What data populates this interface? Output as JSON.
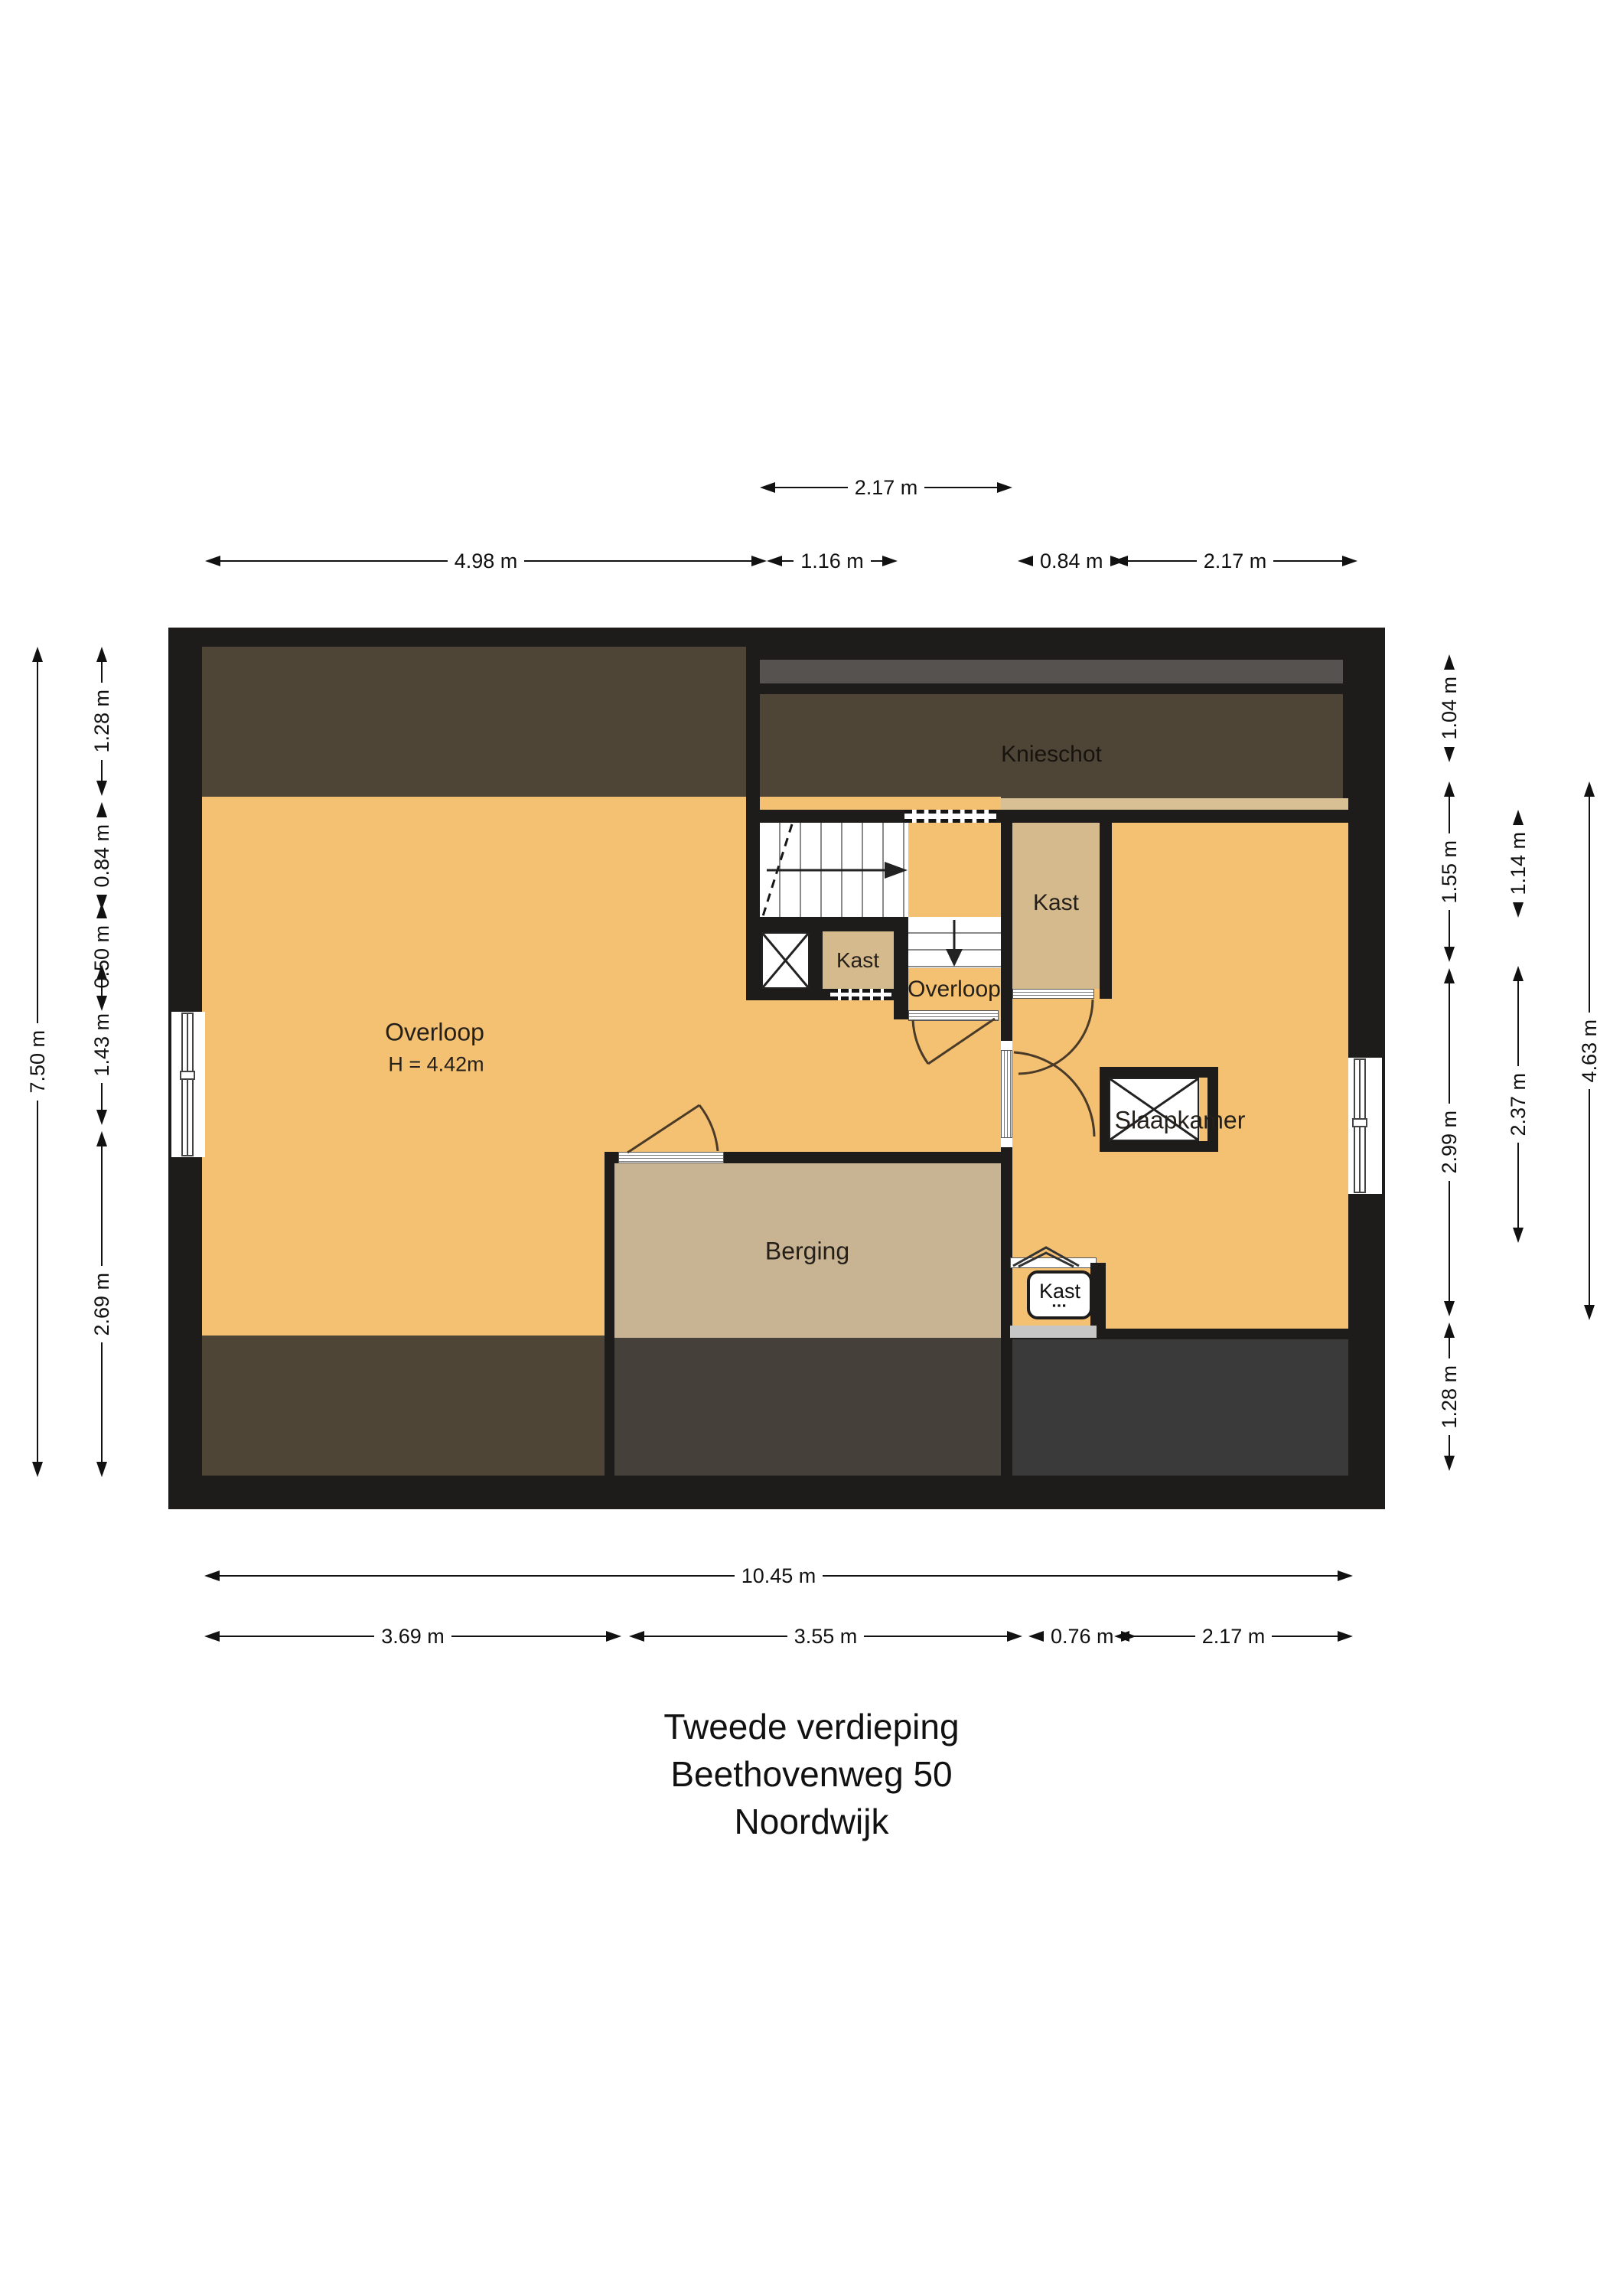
{
  "title": {
    "line1": "Tweede verdieping",
    "line2": "Beethovenweg 50",
    "line3": "Noordwijk"
  },
  "rooms": {
    "knieschot": "Knieschot",
    "overloop_main": "Overloop",
    "overloop_main_height": "H = 4.42m",
    "overloop_small": "Overloop",
    "slaapkamer": "Slaapkamer",
    "berging": "Berging",
    "kast_upper": "Kast",
    "kast_stair": "Kast",
    "kast_lower": "Kast"
  },
  "dimensions": {
    "top_row1": [
      "2.17 m"
    ],
    "top_row2": [
      "4.98 m",
      "1.16 m",
      "0.84 m",
      "2.17 m"
    ],
    "left_outer": [
      "7.50 m"
    ],
    "left_inner": [
      "1.28 m",
      "0.84 m",
      "0.50 m",
      "1.43 m",
      "2.69 m"
    ],
    "right_col1": [
      "1.04 m",
      "1.55 m",
      "2.99 m",
      "1.28 m"
    ],
    "right_col2": [
      "1.14 m",
      "2.37 m"
    ],
    "right_col3": [
      "4.63 m"
    ],
    "bottom_row1": [
      "10.45 m"
    ],
    "bottom_row2": [
      "3.69 m",
      "3.55 m",
      "0.76 m",
      "2.17 m"
    ]
  },
  "icons": {
    "stair_up_arrow": "stair-direction-right",
    "stair_down_arrow": "stair-direction-down",
    "shaft_cross": "duct-shaft-cross",
    "fixture": "meter-fixture"
  },
  "colors": {
    "wall": "#1d1c1a",
    "floor_orange": "#f4c173",
    "tan_kast": "#d4ba8c",
    "tan_berging": "#c8b493",
    "tan_strip": "#d9bf94",
    "attic_brown": "#4e4537",
    "gray_bar": "#555250",
    "bottom_gray_left": "#45413a",
    "bottom_gray_right": "#3b3a3b",
    "sill_gray": "#c6c6c6"
  }
}
